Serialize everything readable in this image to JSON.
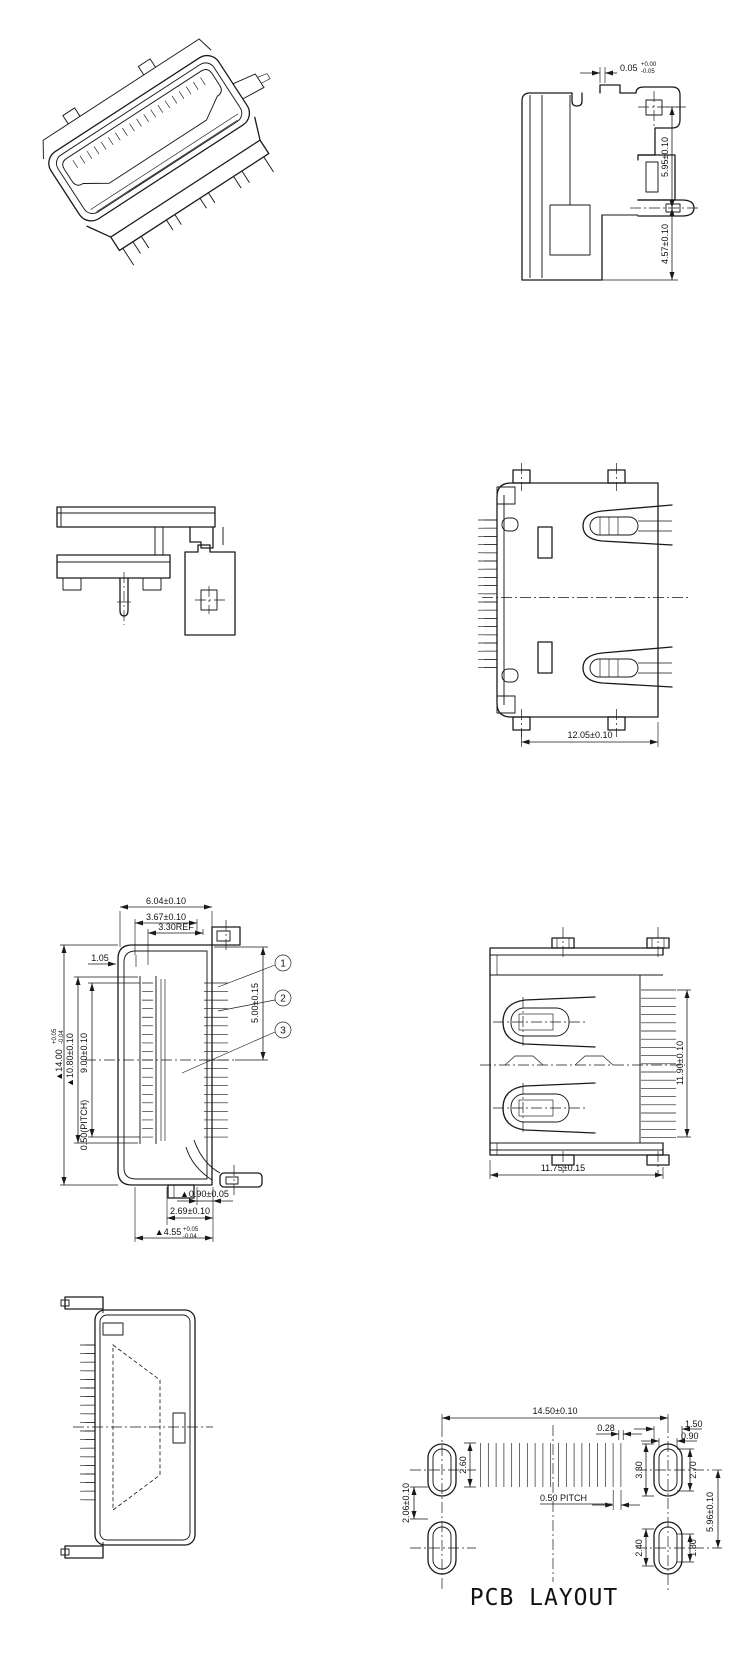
{
  "side_view": {
    "d1": "0.05",
    "d1p": "+0.00",
    "d1m": "-0.05",
    "d2": "5.95±0.10",
    "d3": "4.57±0.10"
  },
  "top_view": {
    "d1": "12.05±0.10"
  },
  "section_view": {
    "top1": "6.04±0.10",
    "top2": "3.67±0.10",
    "top3": "3.30REF",
    "offset": "1.05",
    "left1": "▲14.00",
    "left1p": "+0.05",
    "left1m": "-0.04",
    "left2": "▲10.80±0.10",
    "left3": "9.00±0.10",
    "pitch": "0.50(PITCH)",
    "right1": "5.00±0.15",
    "bot1": "▲0.90±0.05",
    "bot2": "2.69±0.10",
    "bot3": "▲4.55",
    "bot3p": "+0.05",
    "bot3m": "-0.04",
    "c1": "1",
    "c2": "2",
    "c3": "3"
  },
  "rear_view": {
    "height": "11.90±0.10",
    "width": "11.75±0.15"
  },
  "pcb": {
    "span": "14.50±0.10",
    "padw": "0.28",
    "padh": "2.60",
    "pitch": "0.50 PITCH",
    "holeL": "2.06±0.10",
    "r_h": "3.30",
    "r_w": "1.50",
    "r_slot_w": "0.90",
    "r_slot_h": "2.70",
    "vspan": "5.96±0.10",
    "b_h": "2.40",
    "b_slot": "1.80",
    "title": "PCB LAYOUT"
  }
}
